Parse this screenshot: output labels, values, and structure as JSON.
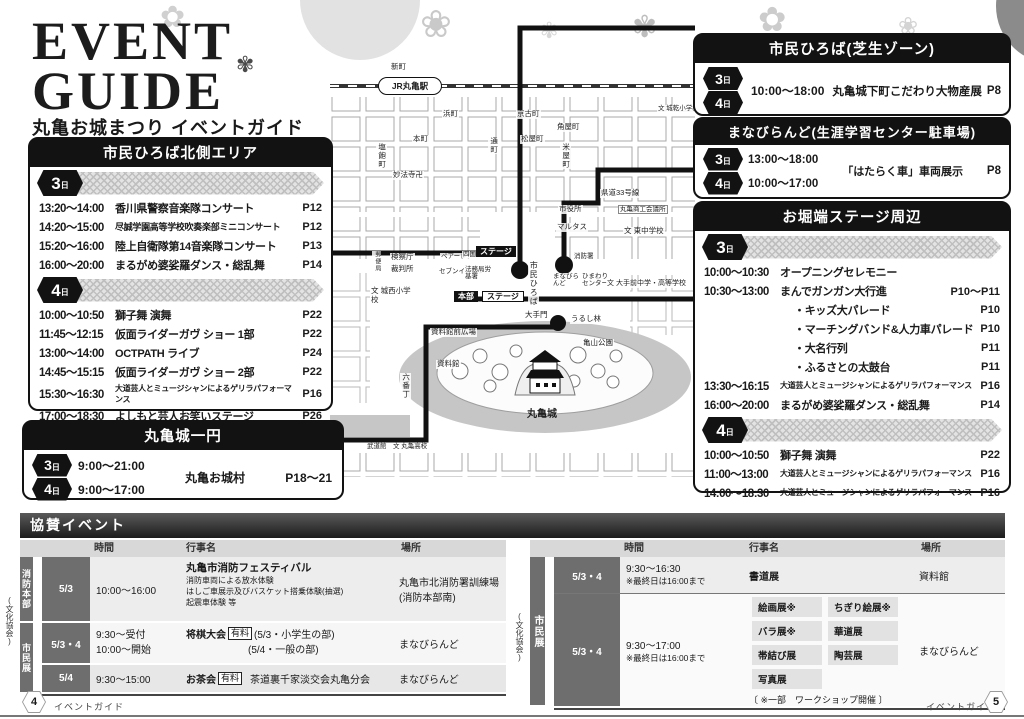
{
  "header": {
    "title1": "EVENT",
    "title2": "GUIDE",
    "subtitle": "丸亀お城まつり イベントガイド"
  },
  "day3": "3",
  "day4": "4",
  "daysuffix": "日",
  "boxes": {
    "kita": {
      "title": "市民ひろば北側エリア",
      "d3": [
        {
          "time": "13:20〜14:00",
          "name": "香川県警察音楽隊コンサート",
          "page": "P12"
        },
        {
          "time": "14:20〜15:00",
          "name": "尽誠学園高等学校吹奏楽部ミニコンサート",
          "page": "P12"
        },
        {
          "time": "15:20〜16:00",
          "name": "陸上自衛隊第14音楽隊コンサート",
          "page": "P13"
        },
        {
          "time": "16:00〜20:00",
          "name": "まるがめ婆娑羅ダンス・総乱舞",
          "page": "P14"
        }
      ],
      "d4": [
        {
          "time": "10:00〜10:50",
          "name": "獅子舞 演舞",
          "page": "P22"
        },
        {
          "time": "11:45〜12:15",
          "name": "仮面ライダーガヴ ショー 1部",
          "page": "P22"
        },
        {
          "time": "13:00〜14:00",
          "name": "OCTPATH ライブ",
          "page": "P24"
        },
        {
          "time": "14:45〜15:15",
          "name": "仮面ライダーガヴ ショー 2部",
          "page": "P22"
        },
        {
          "time": "15:30〜16:30",
          "name": "大道芸人とミュージシャンによるゲリラパフォーマンス",
          "page": "P16"
        },
        {
          "time": "17:00〜18:30",
          "name": "よしもと芸人お笑いステージ",
          "page": "P26"
        }
      ]
    },
    "shiba": {
      "title": "市民ひろば(芝生ゾーン)",
      "time": "10:00〜18:00",
      "name": "丸亀城下町こだわり大物産展",
      "page": "P8"
    },
    "manabi": {
      "title": "まなびらんど(生涯学習センター駐車場)",
      "t3": "13:00〜18:00",
      "t4": "10:00〜17:00",
      "name": "「はたらく車」車両展示",
      "page": "P8"
    },
    "ohori": {
      "title": "お堀端ステージ周辺",
      "d3": [
        {
          "time": "10:00〜10:30",
          "name": "オープニングセレモニー",
          "page": ""
        },
        {
          "time": "10:30〜13:00",
          "name": "まんでガンガン大行進",
          "page": "P10〜P11"
        },
        {
          "time": "",
          "name": "・キッズ大パレード",
          "page": "P10"
        },
        {
          "time": "",
          "name": "・マーチングバンド&人力車パレード",
          "page": "P10"
        },
        {
          "time": "",
          "name": "・大名行列",
          "page": "P11"
        },
        {
          "time": "",
          "name": "・ふるさとの太鼓台",
          "page": "P11"
        },
        {
          "time": "13:30〜16:15",
          "name": "大道芸人とミュージシャンによるゲリラパフォーマンス",
          "page": "P16"
        },
        {
          "time": "16:00〜20:00",
          "name": "まるがめ婆娑羅ダンス・総乱舞",
          "page": "P14"
        }
      ],
      "d4": [
        {
          "time": "10:00〜10:50",
          "name": "獅子舞 演舞",
          "page": "P22"
        },
        {
          "time": "11:00〜13:00",
          "name": "大道芸人とミュージシャンによるゲリラパフォーマンス",
          "page": "P16"
        },
        {
          "time": "14:00〜18:30",
          "name": "大道芸人とミュージシャンによるゲリラパフォーマンス",
          "page": "P16"
        }
      ]
    },
    "ichien": {
      "title": "丸亀城一円",
      "t3": "9:00〜21:00",
      "t4": "9:00〜17:00",
      "name": "丸亀お城村",
      "page": "P18〜21"
    }
  },
  "map": {
    "labels": {
      "station": "JR丸亀駅",
      "shinmachi": "新町",
      "hamacho": "浜町",
      "kyokocho": "京古町",
      "kadoyacho": "角屋町",
      "joken": "文 城乾小学校",
      "honmachi": "本町",
      "torimachi": "通町",
      "matsuyacho": "松屋町",
      "komeyacho": "米屋町",
      "shiwakucho": "塩飽町",
      "myohoji": "妙法寺卍",
      "shiyakusho": "市役所",
      "marutasu": "マルタス",
      "kendo": "県道33号線",
      "shoko": "丸亀商工会議所",
      "higashichu": "文 東中学校",
      "kensatsucho": "検察庁",
      "saibansho": "裁判所",
      "yubinkyoku": "郵便局",
      "peare": "ペアーレ",
      "shikokudenryoku": "四国電力",
      "sevenireven": "セブンイレブン",
      "homukyoku": "法務局労基署",
      "stage1": "ステージ",
      "shiminhiroba": "市民ひろば",
      "shobosho": "消防署",
      "manabirando": "まなびらんど",
      "himawari": "ひまわりセンター",
      "otemaechu": "文 大手前中学・高等学校",
      "honbu": "本部",
      "stage2": "ステージ",
      "josei": "文 城西小学校",
      "shiryokanmae": "資料館前広場",
      "shiryokan": "資料館",
      "otemon": "大手門",
      "urushibayashi": "うるし林",
      "kameyamakoen": "亀山公園",
      "rokubancho": "六番丁",
      "marugamejo": "丸亀城",
      "budokan": "武道館",
      "marugamekoko": "文 丸亀高校"
    }
  },
  "sponsor": {
    "title": "協賛イベント",
    "h": {
      "time": "時間",
      "event": "行事名",
      "place": "場所"
    },
    "bunka": "(文化協会)",
    "left": {
      "g1": "消防本部",
      "g2": "市民展",
      "r1": {
        "date": "5/3",
        "time": "10:00〜16:00",
        "name": "丸亀市消防フェスティバル",
        "sub1": "消防車両による放水体験",
        "sub2": "はしご車展示及びバスケット搭乗体験(抽選)",
        "sub3": "起震車体験 等",
        "place1": "丸亀市北消防署訓練場",
        "place2": "(消防本部南)"
      },
      "r2": {
        "date": "5/3・4",
        "time1": "9:30〜受付",
        "time2": "10:00〜開始",
        "name": "将棋大会",
        "fee": "有料",
        "detail1": "(5/3・小学生の部)",
        "detail2": "(5/4・一般の部)",
        "place": "まなびらんど"
      },
      "r3": {
        "date": "5/4",
        "time": "9:30〜15:00",
        "name": "お茶会",
        "fee": "有料",
        "detail": "茶道裏千家淡交会丸亀分会",
        "place": "まなびらんど"
      }
    },
    "right": {
      "g": "市民展",
      "r1": {
        "date": "5/3・4",
        "time": "9:30〜16:30",
        "note": "※最終日は16:00まで",
        "name": "書道展",
        "place": "資料館"
      },
      "r2": {
        "date": "5/3・4",
        "time": "9:30〜17:00",
        "note": "※最終日は16:00まで",
        "chips": [
          "絵画展※",
          "ちぎり絵展※",
          "バラ展※",
          "華道展",
          "帯結び展",
          "陶芸展",
          "写真展"
        ],
        "footnote": "〔 ※一部　ワークショップ開催 〕",
        "place": "まなびらんど"
      }
    }
  },
  "footer": {
    "left_page": "4",
    "right_page": "5",
    "label": "イベントガイド"
  }
}
